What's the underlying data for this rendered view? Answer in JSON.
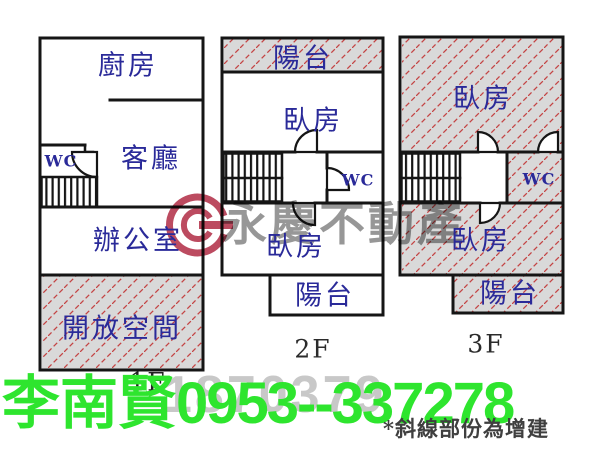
{
  "plans": {
    "f1": {
      "floor_label": "1F",
      "rooms": {
        "kitchen": "廚房",
        "living": "客廳",
        "wc": "WC",
        "office": "辦公室",
        "open_space": "開放空間"
      }
    },
    "f2": {
      "floor_label": "2F",
      "rooms": {
        "balcony_top": "陽台",
        "bedroom_top": "臥房",
        "wc": "WC",
        "bedroom_bottom": "臥房",
        "balcony_bottom": "陽台"
      }
    },
    "f3": {
      "floor_label": "3F",
      "rooms": {
        "bedroom_top": "臥房",
        "wc": "WC",
        "bedroom_bottom": "臥房",
        "balcony": "陽台"
      }
    }
  },
  "watermark": {
    "brand": "永慶不動產",
    "listing_number": "1870379",
    "logo_icon": "yungching-logo-icon"
  },
  "agent": {
    "name": "李南賢",
    "phone": "0953--337278"
  },
  "note": {
    "text": "*斜線部份為增建"
  },
  "colors": {
    "label_navy": "#2a2a99",
    "wall_black": "#151515",
    "hatch_bg": "#d9d9d9",
    "hatch_line": "#c44444",
    "agent_green": "#2ee52e",
    "watermark_gray": "#6e6e6e",
    "number_gray": "#c8c8c8",
    "logo_red": "#b02b44",
    "note_gray": "#3f3f3f"
  }
}
